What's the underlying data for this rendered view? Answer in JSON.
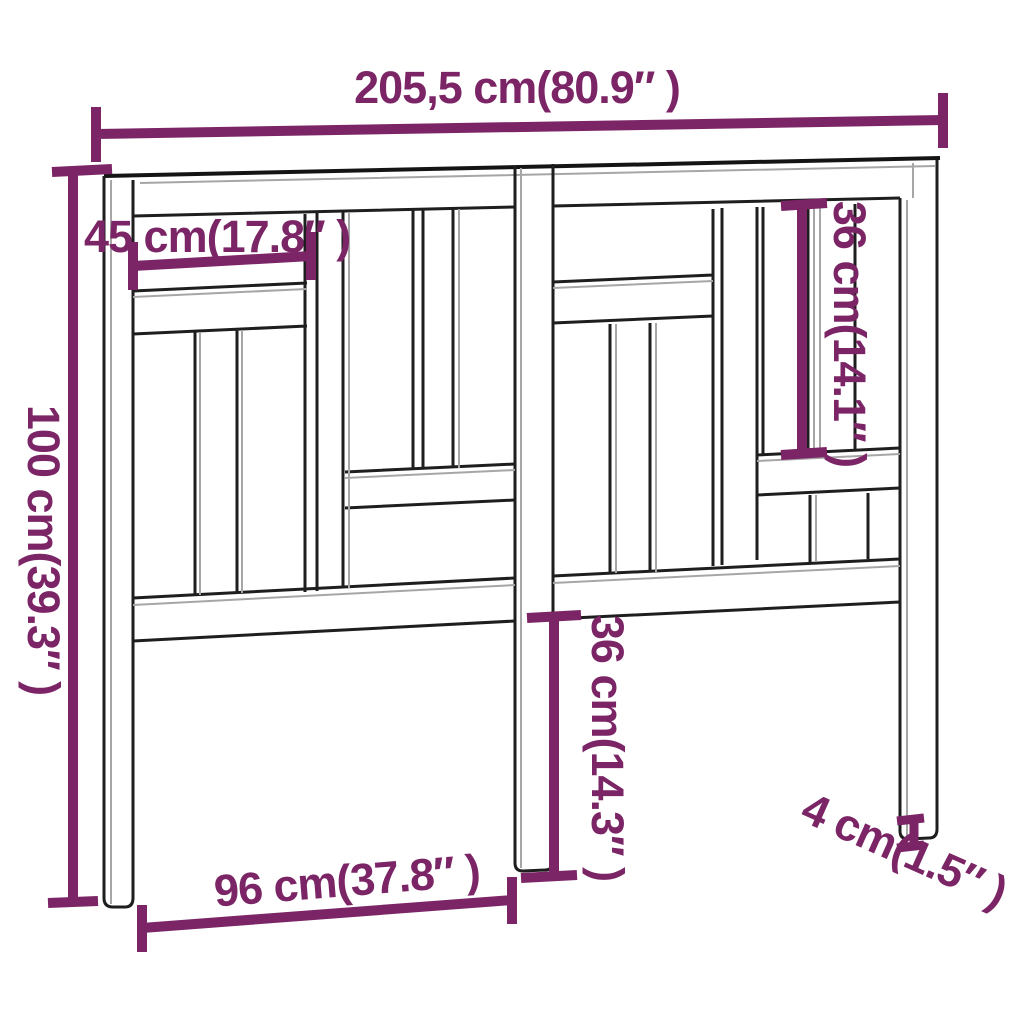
{
  "diagram": {
    "subject": "bed headboard dimension line drawing",
    "colors": {
      "dimension": "#7B2566",
      "outline_dark": "#1e1e1e",
      "outline_light": "#a6a6a6",
      "background": "#ffffff"
    },
    "dimensions": {
      "total_width": {
        "label": "205,5 cm(80.9″ )",
        "cm": "205,5",
        "in": "80.9"
      },
      "left_rail_width": {
        "label": "45 cm(17.8″ )",
        "cm": "45",
        "in": "17.8"
      },
      "total_height": {
        "label": "100 cm(39.3″ )",
        "cm": "100",
        "in": "39.3"
      },
      "right_slat_height": {
        "label": "36 cm(14.1″ )",
        "cm": "36",
        "in": "14.1"
      },
      "center_leg_height": {
        "label": "36 cm(14.3″ )",
        "cm": "36",
        "in": "14.3"
      },
      "inner_leg_span": {
        "label": "96 cm(37.8″ )",
        "cm": "96",
        "in": "37.8"
      },
      "leg_thickness": {
        "label": "4 cm(1.5″ )",
        "cm": "4",
        "in": "1.5"
      }
    }
  }
}
